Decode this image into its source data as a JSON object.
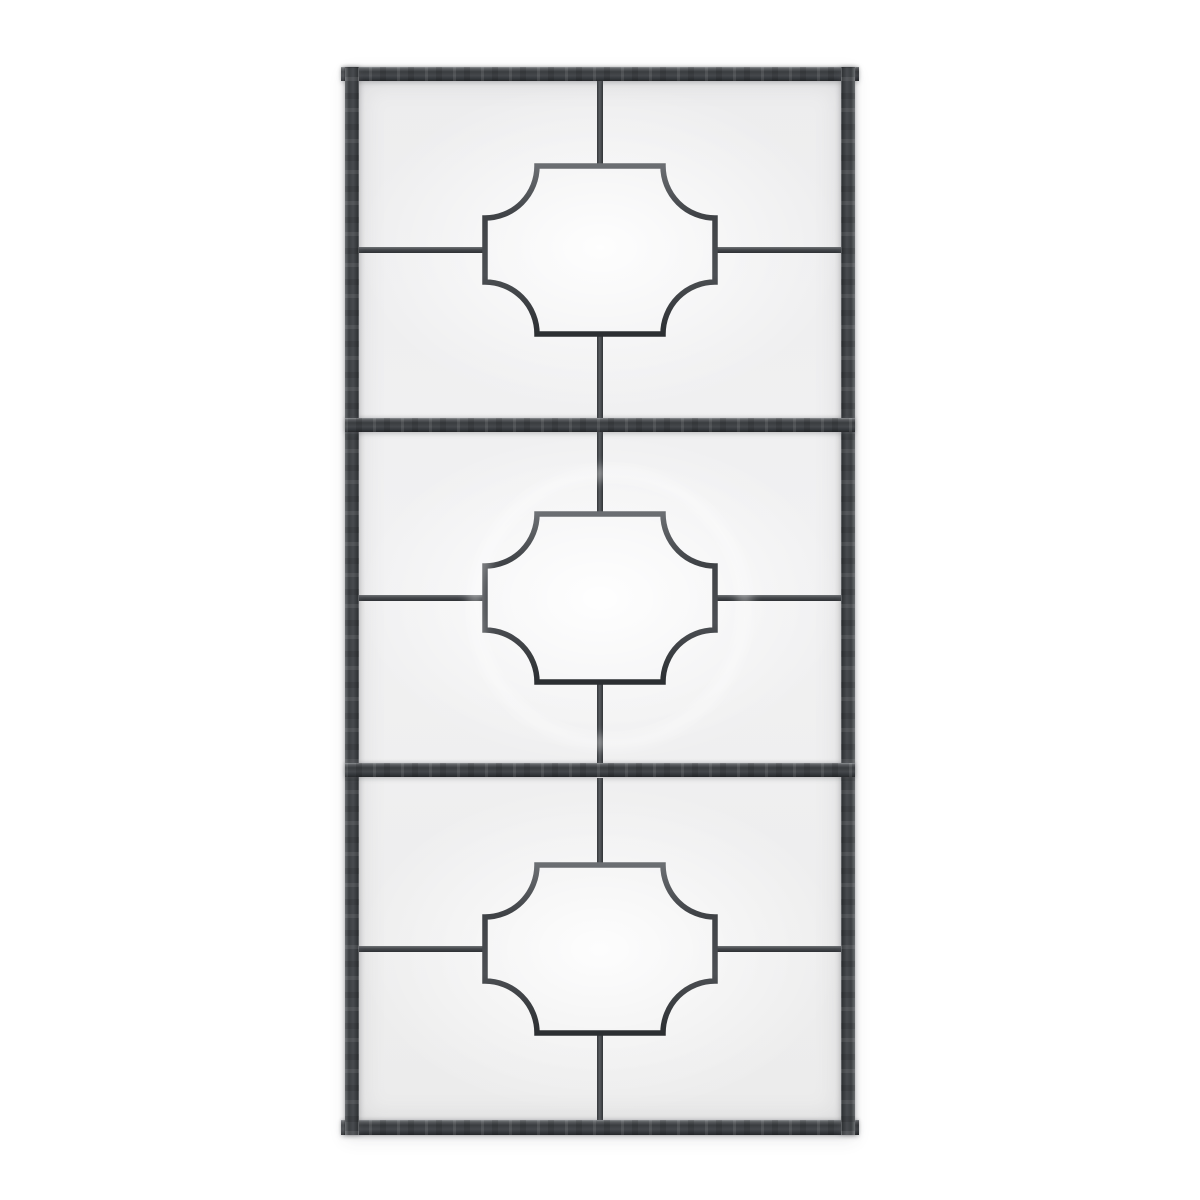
{
  "scene": {
    "subject": "Product photo of a tall rectangular windowpane wall mirror",
    "style": "Aged charcoal iron frame, three stacked sections, each with a central quatrefoil medallion joined by thin muntin bars",
    "background_color": "#ffffff"
  },
  "palette": {
    "frame_base": "#3e4145",
    "frame_mid": "#45484c",
    "frame_highlight": "#9a9da0",
    "frame_shadow": "#26282b",
    "muntin_color": "#4a4d51",
    "glass_edge": "#ececed",
    "glass_center": "#fafafb"
  },
  "mirror": {
    "outer": {
      "left": 345,
      "top": 67,
      "width": 510,
      "height": 1068
    },
    "frame_thickness": 14,
    "bottom_thickness": 15,
    "frame_lip_overhang": 4,
    "divider_thickness": 14,
    "dividers_y_in_glass": [
      337,
      682
    ],
    "glass": {
      "width": 482,
      "height": 1039,
      "center_x": 241
    },
    "muntin_thickness": 6,
    "medallion": {
      "width": 230,
      "height": 168,
      "corner_radius": 52,
      "stroke": 5.5
    },
    "sections": [
      {
        "name": "top",
        "top": 0,
        "bottom": 337
      },
      {
        "name": "middle",
        "top": 351,
        "bottom": 682
      },
      {
        "name": "bottom",
        "top": 697,
        "bottom": 1039
      }
    ],
    "reflection_ring": {
      "radius": 130,
      "sections": [
        "middle"
      ]
    }
  }
}
